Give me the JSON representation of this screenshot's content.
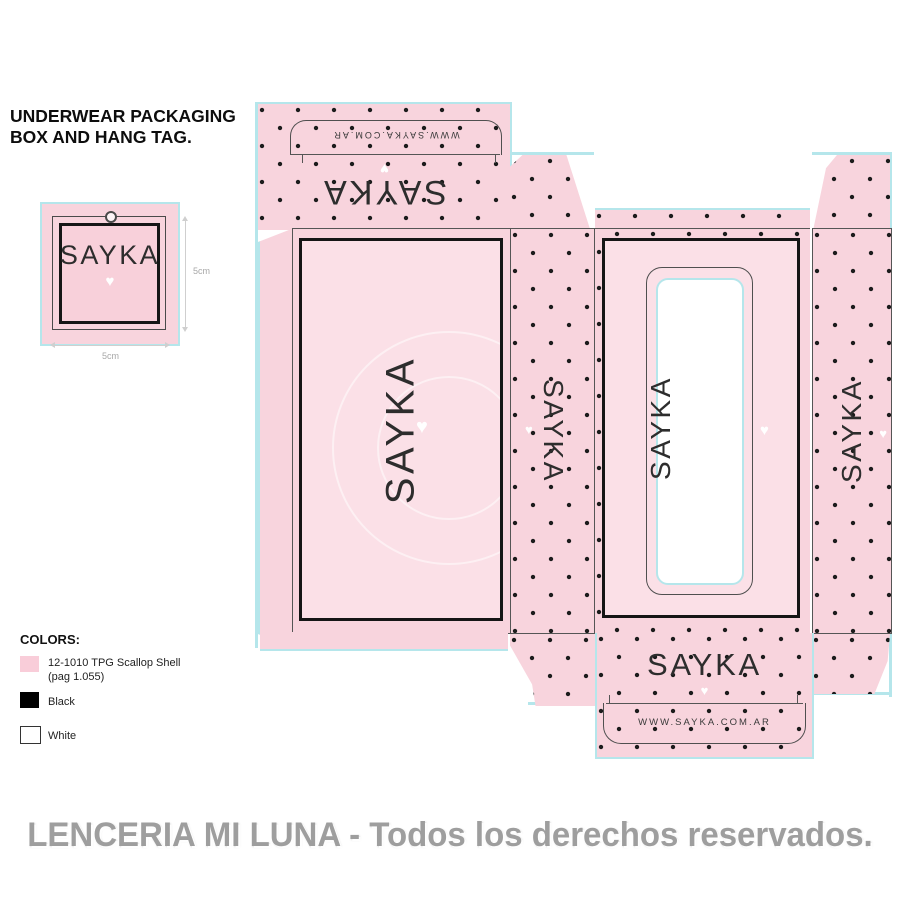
{
  "title": {
    "line1": "UNDERWEAR PACKAGING",
    "line2": "BOX AND HANG TAG."
  },
  "hang_tag": {
    "brand": "SAYKA",
    "heart": "♥",
    "width_label": "5cm",
    "height_label": "5cm"
  },
  "dieline": {
    "brand": "SAYKA",
    "heart": "♥",
    "url": "WWW.SAYKA.COM.AR"
  },
  "legend": {
    "heading": "COLORS:",
    "items": [
      {
        "label": "12-1010 TPG Scallop Shell",
        "sub": "(pag 1.055)",
        "swatch": "#f9cdd9"
      },
      {
        "label": "Black",
        "sub": "",
        "swatch": "#000000"
      },
      {
        "label": "White",
        "sub": "",
        "swatch": "#ffffff"
      }
    ]
  },
  "watermark": "LENCERIA MI LUNA - Todos los derechos reservados.",
  "colors": {
    "pink": "#f8d4dd",
    "pink_light": "#fbe0e7",
    "cyan": "#b5e6eb",
    "ink": "#1c1c1c",
    "gray": "#9e9e9e"
  }
}
